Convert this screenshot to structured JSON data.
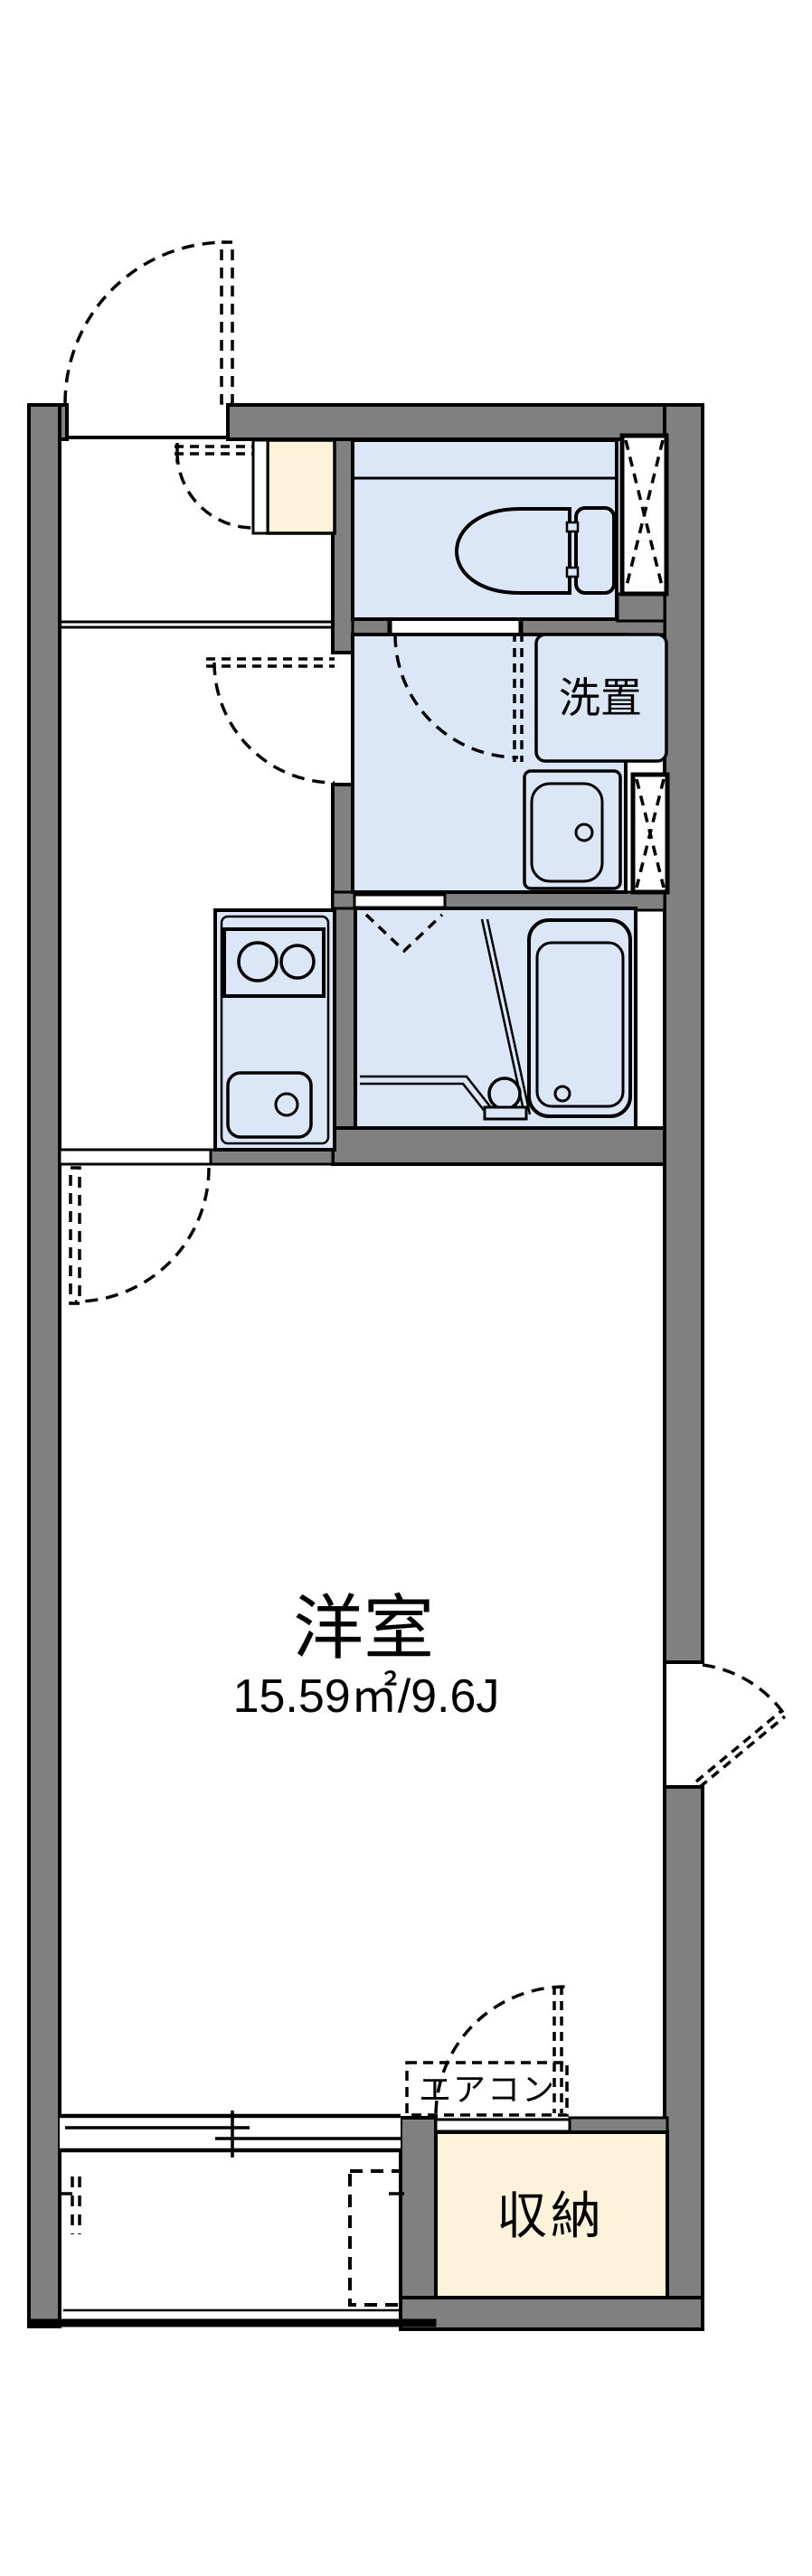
{
  "floorplan": {
    "labels": {
      "main_room": "洋室",
      "main_room_area": "15.59㎡/9.6J",
      "laundry": "洗置",
      "aircon": "エアコン",
      "storage": "収納"
    },
    "colors": {
      "wall": "#808080",
      "wet_room": "#dbe6f7",
      "cabinet": "#fdf2da",
      "line": "#000000",
      "background": "#ffffff"
    }
  }
}
